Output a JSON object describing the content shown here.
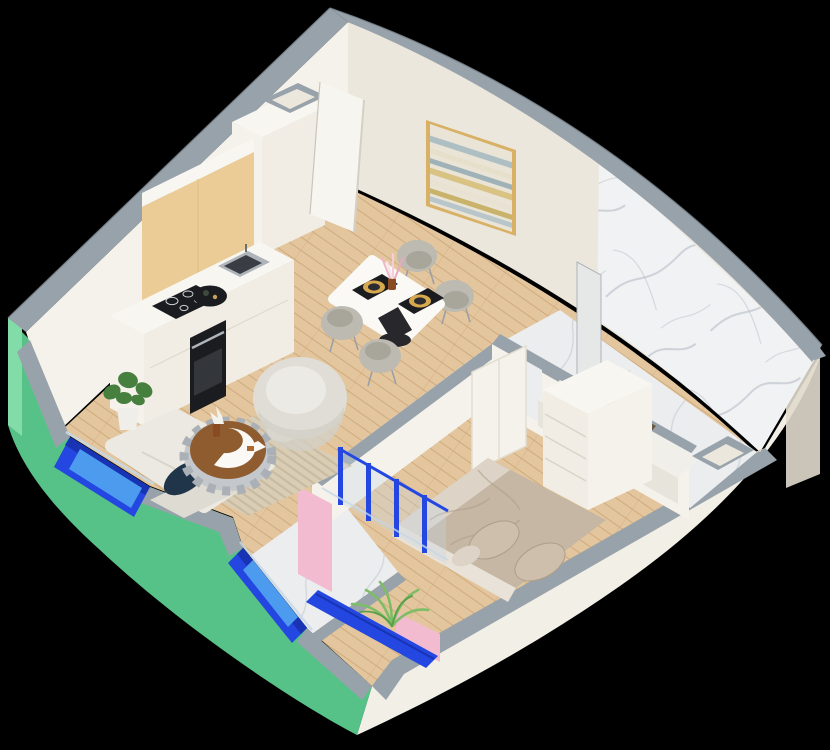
{
  "scene": {
    "title": "isometric-apartment-floorplan-render",
    "projection": "isometric-cutaway-3d",
    "background": "#000000"
  },
  "palette": {
    "background": "#000000",
    "wallTopGray": "#98A2AA",
    "wallTopGrayDark": "#7E8890",
    "exteriorGreen": "#57C287",
    "exteriorGreenLight": "#82DCA8",
    "facadeWhite": "#F2EFE7",
    "interiorCream": "#ECE7DC",
    "interiorCreamShade": "#E0DACC",
    "wallWhite": "#F5F2EB",
    "floorWood": "#E4C69E",
    "floorWoodLine": "#C9A273",
    "marbleWhite": "#F1F2F4",
    "marbleFloor": "#EBEDEF",
    "marbleVein": "#AEB6C0",
    "windowBlue": "#2347E0",
    "windowBlueDark": "#1834B4",
    "windowBlueLight": "#4D9BEE",
    "glassTint": "#C7D8E6",
    "accentPink": "#F3BBD0",
    "accentPinkShade": "#E5A6BF",
    "kitchenWood": "#EBCC97",
    "kitchenWoodShade": "#DDB87E",
    "cabinetWhite": "#F1EDE4",
    "counterWhite": "#F8F6F1",
    "applianceBlack": "#1B1C1F",
    "steel": "#AEB4BA",
    "chairGray": "#BCBAB1",
    "chairGrayDark": "#A8A69B",
    "sofaWhite": "#EBE9E1",
    "sofaShade": "#DEDBD2",
    "pillowNavy": "#20354A",
    "rugBeige": "#DACDB6",
    "rugStripe": "#C5B69B",
    "tableWhite": "#FAF9F5",
    "tableBlack": "#28282C",
    "plateGold": "#D6A94F",
    "coffeeWood": "#8F5C30",
    "coffeeMetal": "#C4C8CC",
    "bedDuvet": "#C5B7A4",
    "bedDuvetDark": "#AE9D88",
    "bedSheet": "#DDD4C7",
    "bedPillow": "#CDBFAB",
    "plantGreen": "#477F3E",
    "palmGreen": "#7CBD66",
    "potWhite": "#F0EEE8",
    "paintingFrame": "#D8B167",
    "paintingBg": "#E9E4D6",
    "doorWhite": "#F7F5F0",
    "vanityWhite": "#F1EFE9",
    "towelBox": "#6A5943"
  },
  "rooms": [
    {
      "name": "kitchen",
      "items": [
        "tall-cabinet",
        "upper-wood-cabinets",
        "counter",
        "induction-cooktop",
        "sink",
        "oven",
        "decor-tray",
        "monstera-plant"
      ]
    },
    {
      "name": "living-dining",
      "items": [
        "dining-table",
        "dining-chairs-x4",
        "placemats-x2",
        "flower-vase",
        "armchair",
        "sofa",
        "navy-pillow",
        "striped-rug",
        "round-coffee-table",
        "side-pouf"
      ]
    },
    {
      "name": "hallway",
      "items": [
        "entry-door",
        "duct-shaft"
      ]
    },
    {
      "name": "bathroom",
      "items": [
        "marble-wall",
        "marble-floor",
        "vanity-counter",
        "towel-basket",
        "glass-partition",
        "service-niche"
      ]
    },
    {
      "name": "bedroom",
      "items": [
        "double-bed",
        "pillows-x2",
        "dresser",
        "wardrobe-panels"
      ]
    },
    {
      "name": "balcony",
      "items": [
        "palm-plant",
        "blue-glazed-doors",
        "pink-accent-walls",
        "marble-floor",
        "glass-balustrade"
      ]
    }
  ],
  "wall_art": {
    "type": "abstract-seascape-painting",
    "frame": "gold"
  },
  "window_count": 2,
  "door_state": "entry-door-open"
}
